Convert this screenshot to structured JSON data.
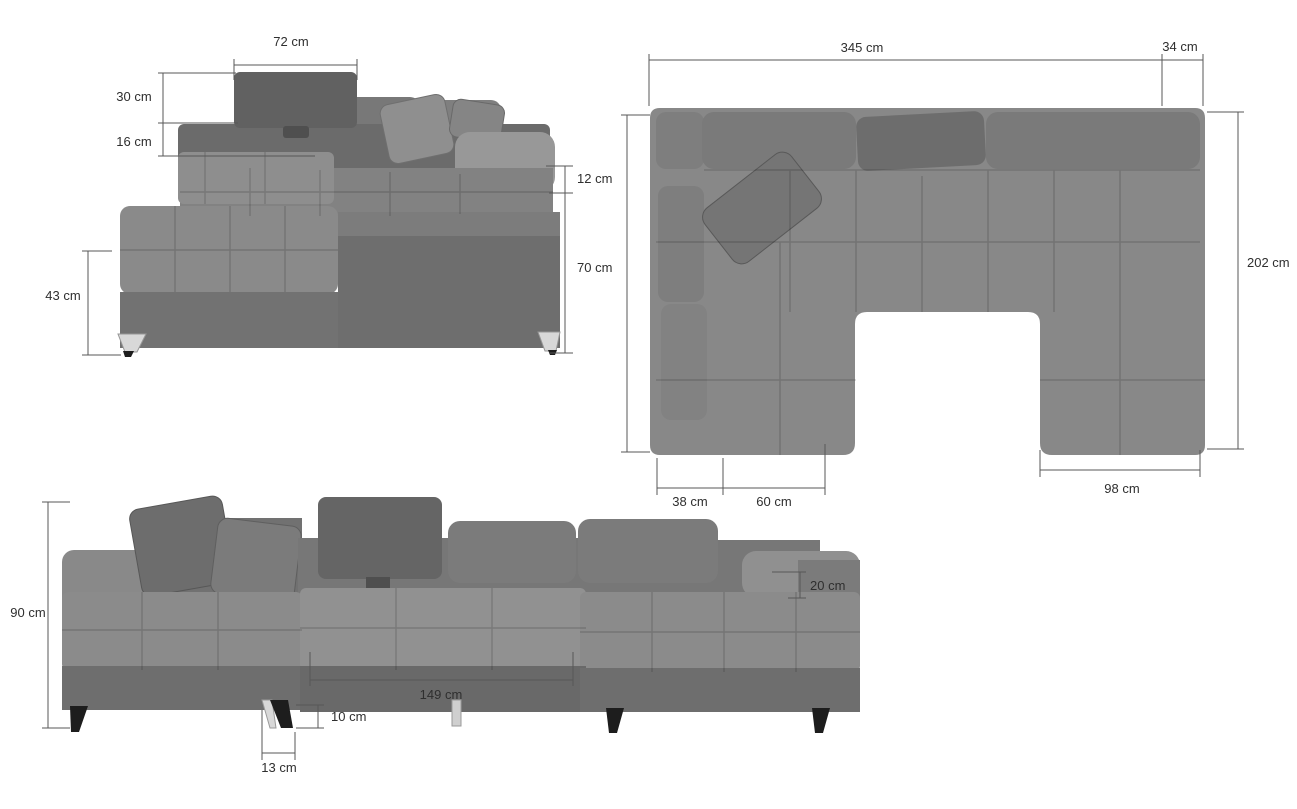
{
  "diagram": {
    "subject": "U-shaped sectional sofa dimension drawing",
    "unit": "cm",
    "background": "#ffffff"
  },
  "views": [
    {
      "id": "side-view",
      "position": "top-left",
      "dimensions": [
        {
          "name": "headrest-width",
          "label": "72 cm",
          "value": 72,
          "unit": "cm"
        },
        {
          "name": "headrest-height",
          "label": "30 cm",
          "value": 30,
          "unit": "cm"
        },
        {
          "name": "headrest-support",
          "label": "16 cm",
          "value": 16,
          "unit": "cm"
        },
        {
          "name": "armrest-thickness",
          "label": "12 cm",
          "value": 12,
          "unit": "cm"
        },
        {
          "name": "base-height",
          "label": "70 cm",
          "value": 70,
          "unit": "cm"
        },
        {
          "name": "chaise-height",
          "label": "43 cm",
          "value": 43,
          "unit": "cm"
        }
      ]
    },
    {
      "id": "top-view",
      "position": "top-right",
      "dimensions": [
        {
          "name": "total-width",
          "label": "345 cm",
          "value": 345,
          "unit": "cm"
        },
        {
          "name": "armrest-width",
          "label": "34 cm",
          "value": 34,
          "unit": "cm"
        },
        {
          "name": "total-depth",
          "label": "202 cm",
          "value": 202,
          "unit": "cm"
        },
        {
          "name": "left-arm-width",
          "label": "38 cm",
          "value": 38,
          "unit": "cm"
        },
        {
          "name": "left-seat-width",
          "label": "60 cm",
          "value": 60,
          "unit": "cm"
        },
        {
          "name": "right-section-width",
          "label": "98 cm",
          "value": 98,
          "unit": "cm"
        }
      ]
    },
    {
      "id": "front-view",
      "position": "bottom",
      "dimensions": [
        {
          "name": "total-height",
          "label": "90 cm",
          "value": 90,
          "unit": "cm"
        },
        {
          "name": "armrest-pad-height",
          "label": "20 cm",
          "value": 20,
          "unit": "cm"
        },
        {
          "name": "center-seat-width",
          "label": "149 cm",
          "value": 149,
          "unit": "cm"
        },
        {
          "name": "leg-height",
          "label": "10 cm",
          "value": 10,
          "unit": "cm"
        },
        {
          "name": "leg-offset",
          "label": "13 cm",
          "value": 13,
          "unit": "cm"
        }
      ]
    }
  ],
  "colors": {
    "background": "#ffffff",
    "dimension_line": "#575757",
    "dimension_text": "#2f2f2f",
    "fabric_dark": "#636363",
    "fabric_mid": "#7b7b7b",
    "fabric_base": "#888888",
    "fabric_light": "#919191",
    "leg_chrome": "#d8d8d8",
    "leg_black": "#1d1d1d"
  }
}
